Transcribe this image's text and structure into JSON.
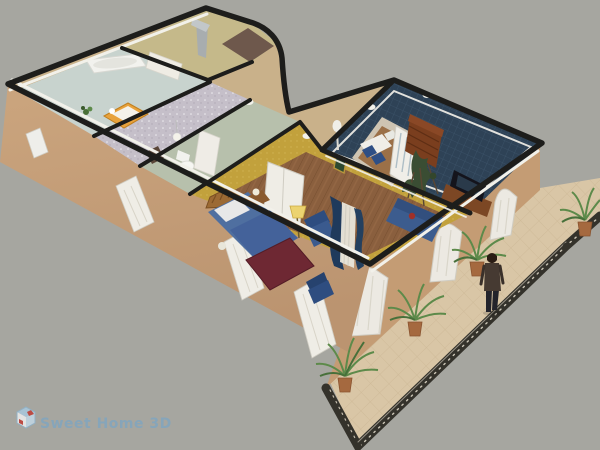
{
  "app": {
    "name": "Sweet Home 3D",
    "watermark": "Sweet Home 3D"
  },
  "scene": {
    "type": "3d-aerial-home-view",
    "description": "Perspective aerial rendering of an L-shaped single-storey home with furnished rooms, open roof, and a front terrace with railing, potted palms and a standing person",
    "rooms": [
      {
        "name": "laundry-bathroom",
        "floor_color": "#c8d3ce"
      },
      {
        "name": "kids-bedroom",
        "floor_color": "#c5bfc9"
      },
      {
        "name": "bathroom",
        "floor_color": "#b7c0ac"
      },
      {
        "name": "kitchen",
        "floor_color": "#c5b98a"
      },
      {
        "name": "entrance-hall",
        "floor_color": "#c9b18a"
      },
      {
        "name": "master-bedroom",
        "floor_color": "#8a5f3e",
        "wall_color": "#c2a13c"
      },
      {
        "name": "living-room",
        "floor_color": "#2e4256"
      },
      {
        "name": "office-nook",
        "floor_color": "#9b7048"
      },
      {
        "name": "terrace",
        "floor_color": "#d9c6a6"
      }
    ],
    "furniture": [
      "bathtub",
      "kids-bed",
      "small-plant",
      "toilet",
      "bathroom-cabinet",
      "pendant-lamp",
      "range-hood",
      "kitchen-cabinets",
      "entry-mat",
      "double-bed",
      "nightstand",
      "table-lamp",
      "blanket-chest",
      "armchair",
      "side-chair",
      "floor-lamp",
      "curtains",
      "double-door",
      "french-door",
      "bookcase",
      "tv",
      "tv-stand",
      "sofa",
      "desk",
      "desk-chairs",
      "indoor-plant",
      "wall-lamps",
      "picture-frame",
      "potted-palm-1",
      "potted-palm-2",
      "potted-palm-3",
      "potted-palm-4",
      "person",
      "balcony-railing",
      "arched-windows"
    ],
    "colors": {
      "background": "#a6a6a0",
      "exterior_wall": "#c49c74",
      "exterior_wall_light": "#cba57e",
      "terrace_floor": "#d9c6a6",
      "railing": "#34322b",
      "wall_top": "#1d1d1b",
      "trim_white": "#f2f1ea",
      "hall_floor": "#c9b18a",
      "blue_gray_floor": "#c8d3ce",
      "sparkle_floor": "#c5bfc9",
      "sage_floor": "#b7c0ac",
      "kitchen_wall": "#c5b98a",
      "mustard_wall": "#c2a13c",
      "wood_floor": "#8a5f3e",
      "navy_floor": "#2e4256",
      "nook_floor": "#9b7048",
      "furniture_blue": "#3c5c8e",
      "bed_blue": "#4f6fa0",
      "bed_wood": "#9c6a34",
      "chest_burgundy": "#6e2833",
      "cabinet_brown": "#7a3e1e",
      "plant_green": "#5d8a4a",
      "pot_terracotta": "#a5693f",
      "watermark_blue": "#7fa5c0"
    }
  }
}
